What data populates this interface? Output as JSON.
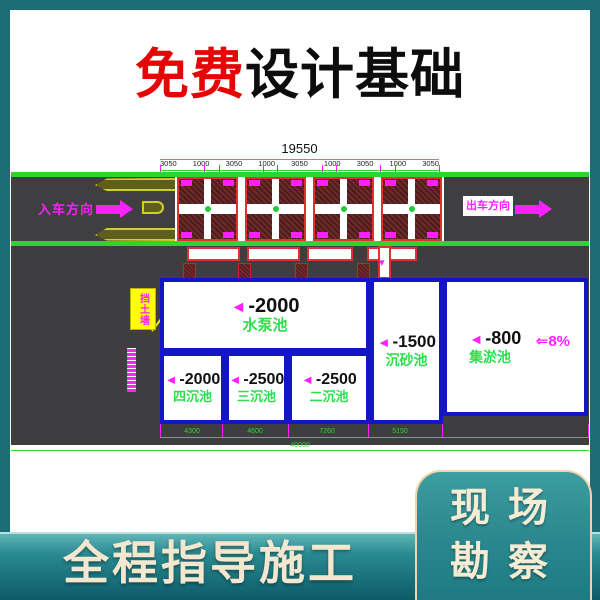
{
  "colors": {
    "teal_background": "#1e6c75",
    "accent_red": "#e60505",
    "cad_magenta": "#ff20ff",
    "cad_green": "#2fd42f",
    "pool_blue": "#1515c8",
    "road_gray": "#3f3f41",
    "outline_red": "#e03030",
    "island_olive": "#cdd123",
    "callout_yellow": "#ffff00",
    "cream_text": "#f3e8cf"
  },
  "header": {
    "title_highlight": "免费",
    "title_rest": "设计基础"
  },
  "drawing": {
    "dims_top": {
      "total": "19550",
      "segments": [
        "3050",
        "1000",
        "3050",
        "1000",
        "3050",
        "1000",
        "3050",
        "1000",
        "3050"
      ]
    },
    "road": {
      "entry_label": "入车方向",
      "exit_label": "出车方向"
    },
    "marker": "◄",
    "down_arrow": "▾",
    "callout_label": "挡土墙",
    "pools": {
      "pump": {
        "depth": "-2000",
        "name": "水泵池"
      },
      "fourth": {
        "depth": "-2000",
        "name": "四沉池"
      },
      "third": {
        "depth": "-2500",
        "name": "三沉池"
      },
      "second": {
        "depth": "-2500",
        "name": "二沉池"
      },
      "grit": {
        "depth": "-1500",
        "name": "沉砂池"
      },
      "silt": {
        "depth": "-800",
        "name": "集淤池"
      }
    },
    "slope": {
      "arrow": "⇐",
      "value": "8%"
    },
    "dims_bottom": {
      "segments": [
        "4300",
        "4600",
        "7260",
        "5150"
      ],
      "total": "40000"
    }
  },
  "footer": {
    "banner": "全程指导施工",
    "panel_line1": "现场",
    "panel_line2": "勘察"
  }
}
